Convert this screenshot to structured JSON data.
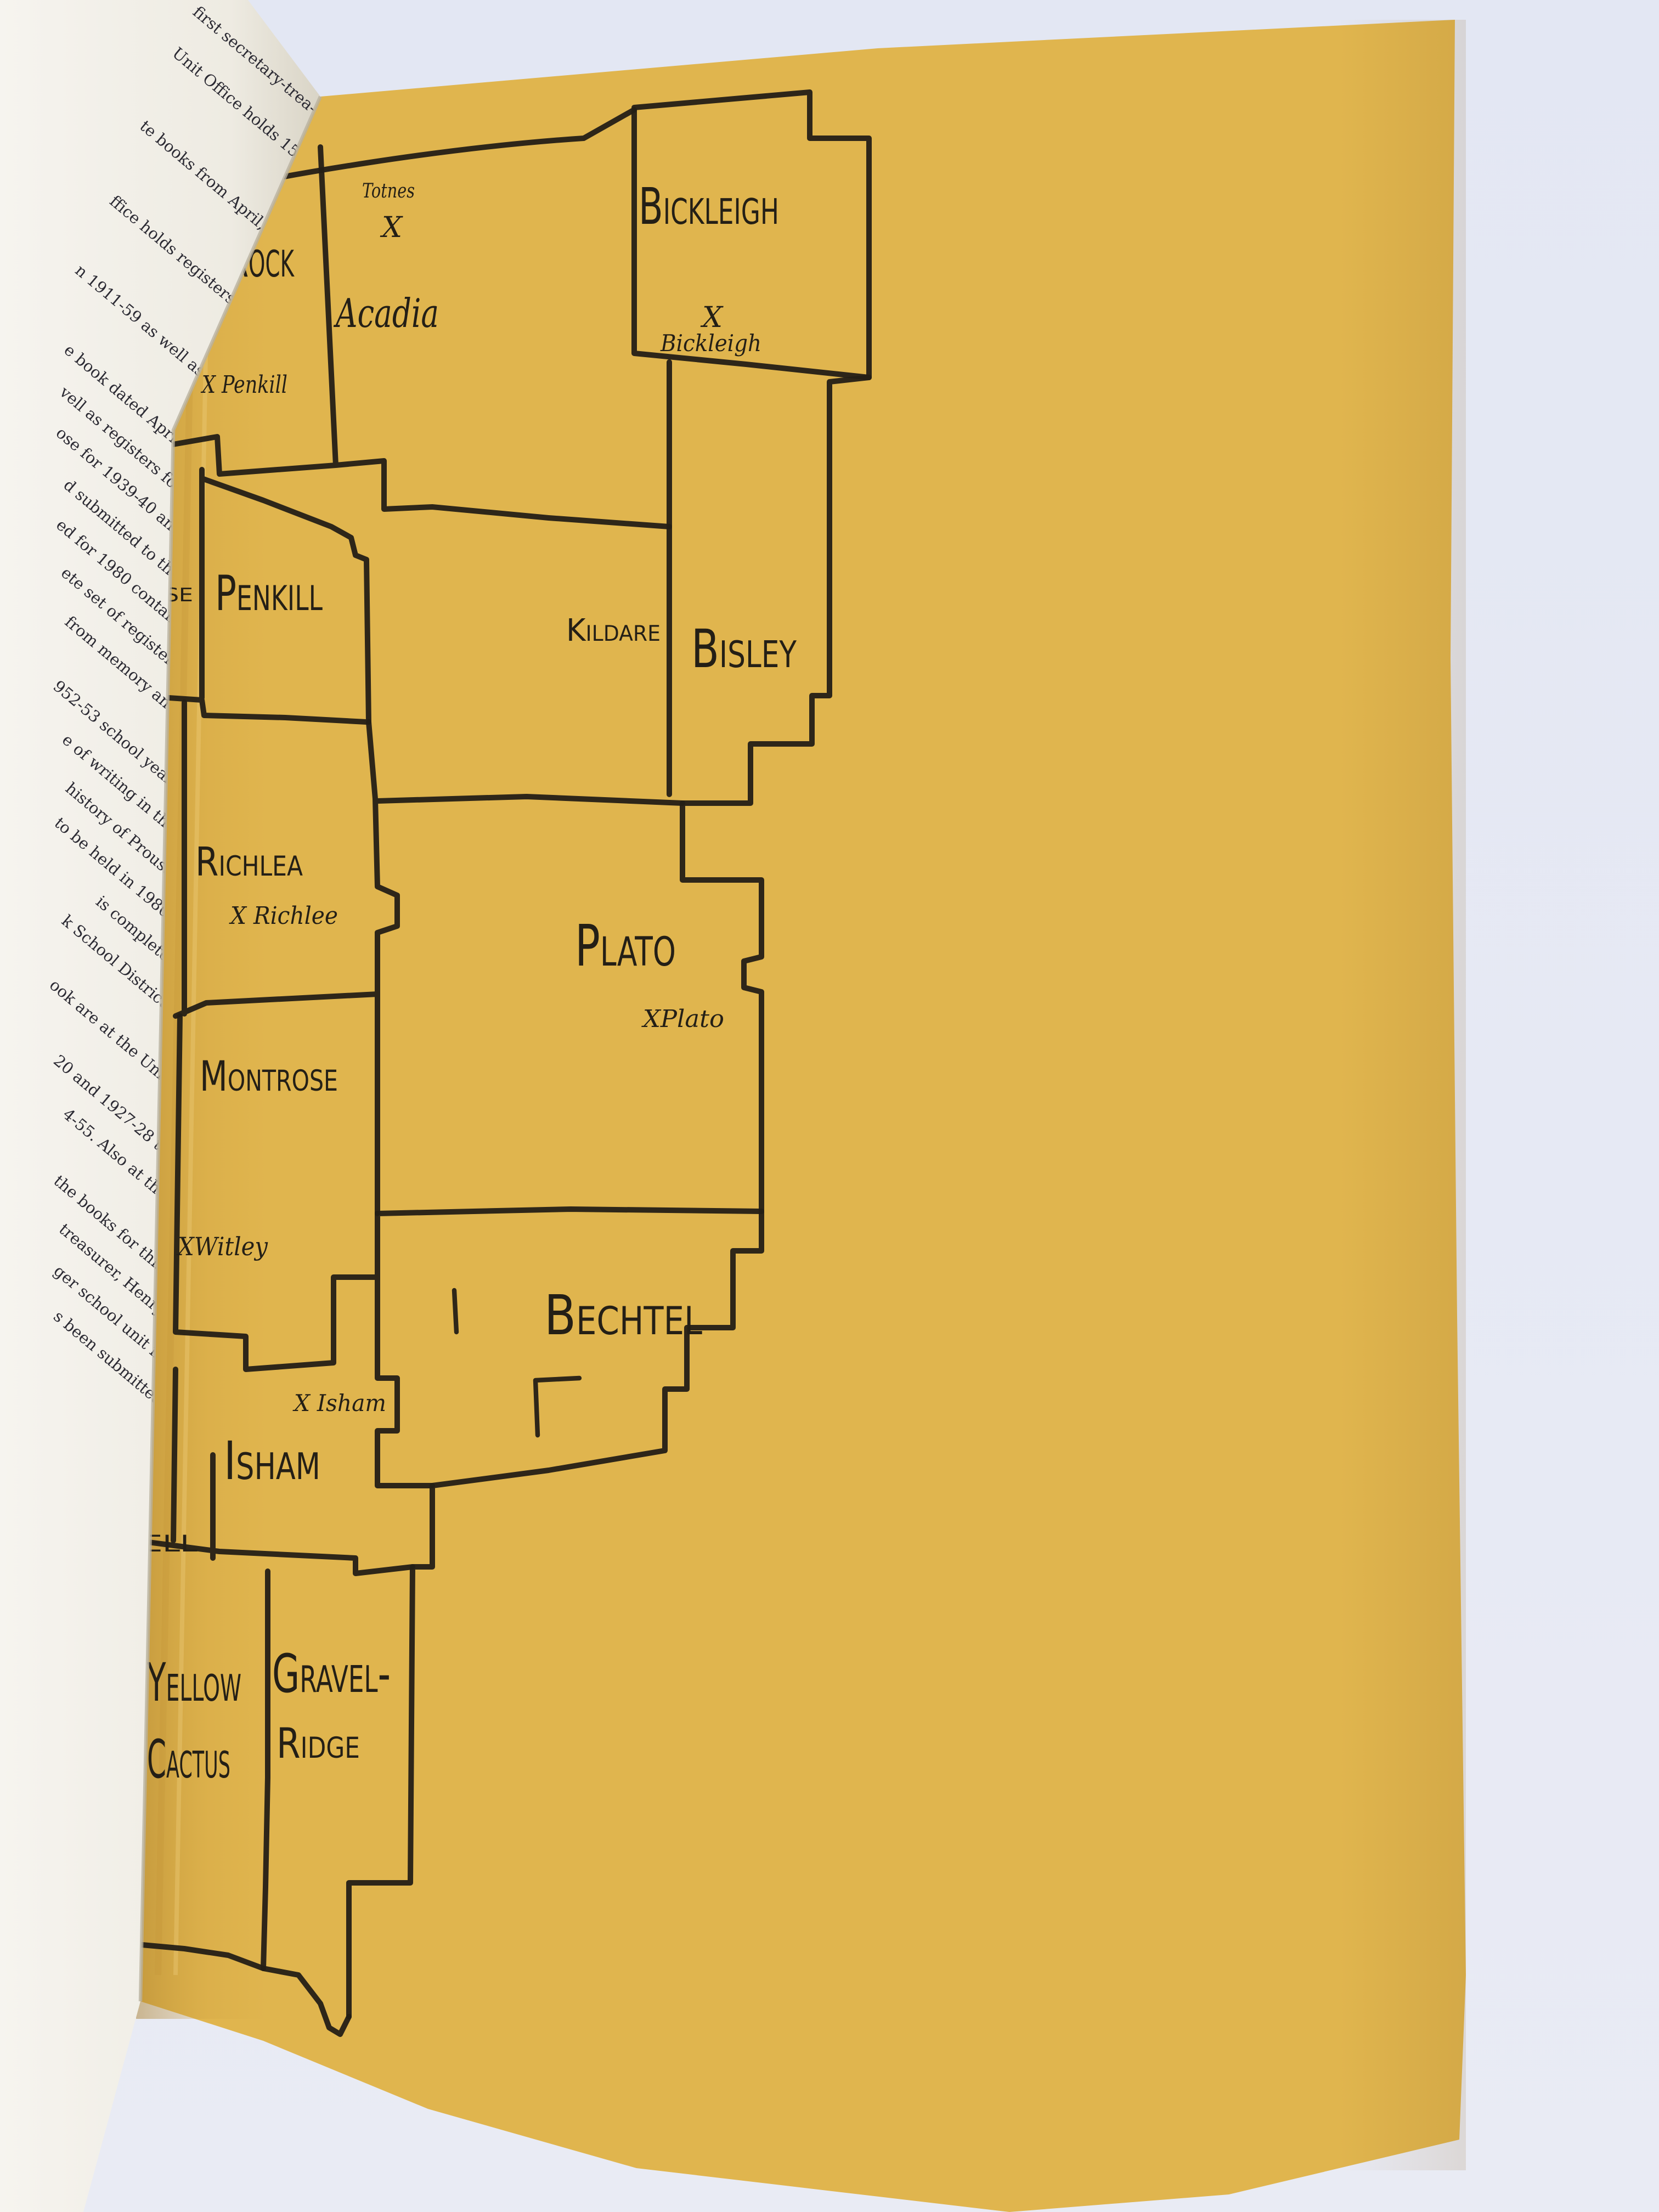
{
  "photo": {
    "backdrop_color": "#e5e8f3",
    "map_page_color": "#e0b54e",
    "left_page_color": "#f4f2ec",
    "ink_color": "#241f16"
  },
  "left_page": {
    "lines": [
      "first secretary-trea-",
      "Unit Office holds 15",
      "te books from April,",
      "ffice holds registers",
      "n 1911-59 as well as",
      "e book dated April,",
      "vell as registers for",
      "ose for 1939-40 and",
      "d submitted to the",
      "ed for 1980 contain",
      "ete set of registers",
      "from memory and",
      "952-53 school year.",
      "e of writing in the",
      "history of Prouse",
      "to be held in 1980;",
      "is complete.",
      "k School District,",
      "ook are at the Unit",
      "20 and 1927-28 to",
      "4-55. Also at the",
      "the books for this",
      "treasurer, Henry",
      "ger school unit in",
      "s been submitted"
    ]
  },
  "map": {
    "districts": [
      {
        "id": "red-rock",
        "label": "Red Rock"
      },
      {
        "id": "acadia",
        "label": "Acadia"
      },
      {
        "id": "bickleigh",
        "label": "Bickleigh"
      },
      {
        "id": "prouse-partial",
        "label": "se"
      },
      {
        "id": "penkill",
        "label": "Penkill"
      },
      {
        "id": "kildare",
        "label": "Kildare"
      },
      {
        "id": "bisley",
        "label": "Bisley"
      },
      {
        "id": "richlea",
        "label": "Richlea"
      },
      {
        "id": "plato",
        "label": "Plato"
      },
      {
        "id": "montrose",
        "label": "Montrose"
      },
      {
        "id": "bechtel",
        "label": "Bechtel"
      },
      {
        "id": "isham",
        "label": "Isham"
      },
      {
        "id": "ell-partial",
        "label": "ell"
      },
      {
        "id": "yellow-cactus",
        "label_line1": "Yellow",
        "label_line2": "Cactus"
      },
      {
        "id": "gravel-ridge",
        "label_line1": "Gravel-",
        "label_line2": "Ridge"
      }
    ],
    "settlements": [
      {
        "id": "totnes",
        "label": "Totnes"
      },
      {
        "id": "totnes-x",
        "label": "X"
      },
      {
        "id": "penkill-x",
        "label": "X Penkill"
      },
      {
        "id": "bickleigh-x",
        "label": "X"
      },
      {
        "id": "bickleigh-town",
        "label": "Bickleigh"
      },
      {
        "id": "richlee-x",
        "label": "X Richlee"
      },
      {
        "id": "plato-x",
        "label": "XPlato"
      },
      {
        "id": "witley-x",
        "label": "XWitley"
      },
      {
        "id": "isham-x",
        "label": "X Isham"
      }
    ]
  }
}
